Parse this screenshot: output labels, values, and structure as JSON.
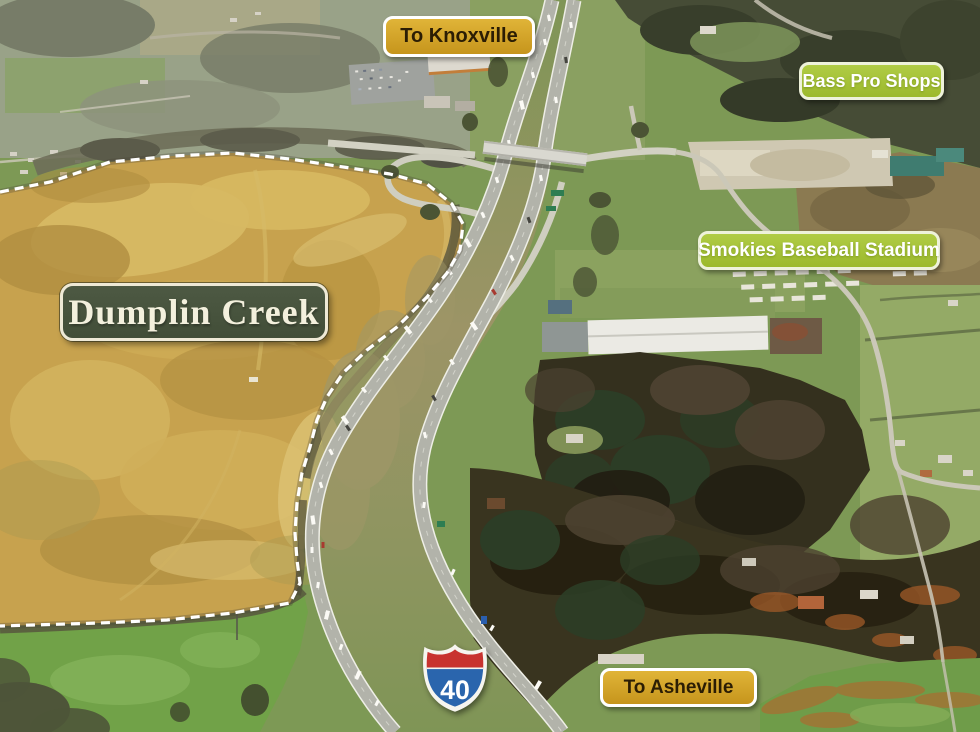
{
  "page": {
    "title": "Dumplin Creek aerial site map"
  },
  "property": {
    "name": "Dumplin Creek",
    "boundary_style": "white dashed outline",
    "highlight_fill": "#c7a24e"
  },
  "direction_signs": [
    {
      "id": "to-knoxville",
      "label": "To Knoxville"
    },
    {
      "id": "to-asheville",
      "label": "To Asheville"
    }
  ],
  "poi_signs": [
    {
      "id": "bass-pro-shops",
      "label": "Bass Pro Shops"
    },
    {
      "id": "smokies-baseball-stadium",
      "label": "Smokies Baseball Stadium"
    }
  ],
  "highway_shield": {
    "icon": "interstate-shield-icon",
    "number": "40"
  },
  "colors": {
    "direction_sign_bg": "#d4a021",
    "direction_sign_border": "#ffffff",
    "direction_sign_text": "#2b1d04",
    "poi_sign_bg": "#a6c436",
    "poi_sign_border": "#eef2da",
    "poi_sign_text": "#ffffff",
    "property_sign_bg": "#46523c",
    "property_sign_border": "#eee9d6",
    "property_sign_text": "#f3f0dd",
    "property_highlight": "#c7a24e",
    "boundary_dash": "#ffffff",
    "shield_red": "#c8332f",
    "shield_blue": "#2a65ad"
  }
}
